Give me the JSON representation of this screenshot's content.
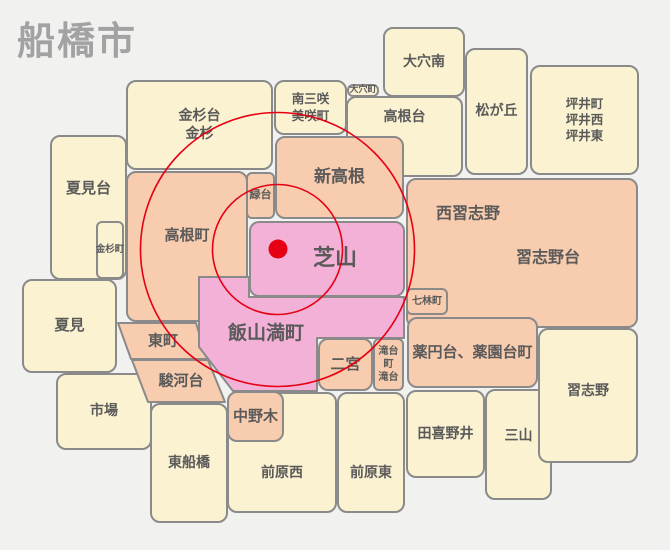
{
  "title": "船橋市",
  "colors": {
    "bg": "#f1f1f0",
    "cream": "#fbf2d1",
    "salmon": "#f8ccae",
    "pink": "#f3b1d8",
    "border": "#8a8a8a",
    "label": "#5a5a5a",
    "title": "#a2a2a2",
    "red": "#e60014"
  },
  "regions": {
    "natsumidai": {
      "label": "夏見台"
    },
    "kanasugicho": {
      "label": "金杉町"
    },
    "natsumi": {
      "label": "夏見"
    },
    "ichiba": {
      "label": "市場"
    },
    "kanasugidai": {
      "label": "金杉台\n金杉"
    },
    "minamimisaki": {
      "label": "南三咲\n美咲町"
    },
    "oanacho": {
      "label": "大穴町"
    },
    "oanaminami": {
      "label": "大穴南"
    },
    "takanedai": {
      "label": "高根台"
    },
    "matsugaoka": {
      "label": "松が丘"
    },
    "tsuboi": {
      "label": "坪井町\n坪井西\n坪井東"
    },
    "takanecho": {
      "label": "高根町"
    },
    "midoridai": {
      "label": "緑台"
    },
    "shintakane": {
      "label": "新高根"
    },
    "nishinarashino": {
      "label": "西習志野"
    },
    "narashinodai": {
      "label": "習志野台"
    },
    "shibayama": {
      "label": "芝山"
    },
    "iiyamamitsucho": {
      "label": "飯山満町"
    },
    "higashicho": {
      "label": "東町"
    },
    "surugadai": {
      "label": "駿河台"
    },
    "nakanogi": {
      "label": "中野木"
    },
    "higashifunabashi": {
      "label": "東船橋"
    },
    "maebaranishi": {
      "label": "前原西"
    },
    "maebarahigashi": {
      "label": "前原東"
    },
    "ninomiya": {
      "label": "二宮"
    },
    "takidaicho": {
      "label": "滝台町\n滝台"
    },
    "nanabayashicho": {
      "label": "七林町"
    },
    "yakuendai": {
      "label": "薬円台、薬園台町"
    },
    "narashino": {
      "label": "習志野"
    },
    "takinoi": {
      "label": "田喜野井"
    },
    "miyama": {
      "label": "三山"
    }
  }
}
